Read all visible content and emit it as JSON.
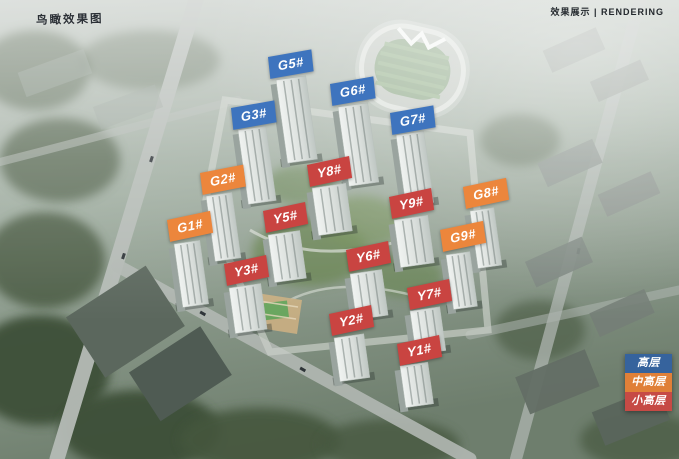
{
  "annotations": {
    "top_left_caption": "鸟瞰效果图",
    "top_right_caption": "效果展示 | RENDERING"
  },
  "colors": {
    "high_rise": "#3E74BE",
    "mid_high_rise": "#EC863C",
    "small_high_rise": "#C94441"
  },
  "legend": {
    "items": [
      {
        "label": "高层",
        "type": "high_rise",
        "color": "#36639D"
      },
      {
        "label": "中高层",
        "type": "mid_high_rise",
        "color": "#E08038"
      },
      {
        "label": "小高层",
        "type": "small_high_rise",
        "color": "#C64A45"
      }
    ]
  },
  "buildings": [
    {
      "id": "G5#",
      "type": "high_rise",
      "label_x": 268,
      "label_y": 57,
      "rot": -10,
      "tower": {
        "x": 276,
        "y": 80,
        "w": 30,
        "h": 84
      }
    },
    {
      "id": "G6#",
      "type": "high_rise",
      "label_x": 330,
      "label_y": 84,
      "rot": -10,
      "tower": {
        "x": 338,
        "y": 107,
        "w": 30,
        "h": 80
      }
    },
    {
      "id": "G3#",
      "type": "high_rise",
      "label_x": 231,
      "label_y": 108,
      "rot": -10,
      "tower": {
        "x": 238,
        "y": 130,
        "w": 28,
        "h": 75
      }
    },
    {
      "id": "G7#",
      "type": "high_rise",
      "label_x": 390,
      "label_y": 113,
      "rot": -10,
      "tower": {
        "x": 396,
        "y": 135,
        "w": 28,
        "h": 72
      }
    },
    {
      "id": "G2#",
      "type": "mid_high_rise",
      "label_x": 200,
      "label_y": 173,
      "rot": -11,
      "tower": {
        "x": 206,
        "y": 196,
        "w": 26,
        "h": 66
      }
    },
    {
      "id": "G1#",
      "type": "mid_high_rise",
      "label_x": 167,
      "label_y": 220,
      "rot": -12,
      "tower": {
        "x": 174,
        "y": 244,
        "w": 26,
        "h": 64
      }
    },
    {
      "id": "G8#",
      "type": "mid_high_rise",
      "label_x": 463,
      "label_y": 187,
      "rot": -12,
      "tower": {
        "x": 470,
        "y": 211,
        "w": 24,
        "h": 58
      }
    },
    {
      "id": "G9#",
      "type": "mid_high_rise",
      "label_x": 440,
      "label_y": 230,
      "rot": -12,
      "tower": {
        "x": 446,
        "y": 255,
        "w": 24,
        "h": 55
      }
    },
    {
      "id": "Y8#",
      "type": "small_high_rise",
      "label_x": 307,
      "label_y": 165,
      "rot": -12,
      "tower": {
        "x": 312,
        "y": 188,
        "w": 34,
        "h": 48
      }
    },
    {
      "id": "Y9#",
      "type": "small_high_rise",
      "label_x": 389,
      "label_y": 197,
      "rot": -12,
      "tower": {
        "x": 394,
        "y": 220,
        "w": 34,
        "h": 48
      }
    },
    {
      "id": "Y5#",
      "type": "small_high_rise",
      "label_x": 263,
      "label_y": 211,
      "rot": -12,
      "tower": {
        "x": 268,
        "y": 235,
        "w": 32,
        "h": 48
      }
    },
    {
      "id": "Y6#",
      "type": "small_high_rise",
      "label_x": 346,
      "label_y": 250,
      "rot": -12,
      "tower": {
        "x": 350,
        "y": 274,
        "w": 32,
        "h": 46
      }
    },
    {
      "id": "Y3#",
      "type": "small_high_rise",
      "label_x": 224,
      "label_y": 264,
      "rot": -12,
      "tower": {
        "x": 229,
        "y": 288,
        "w": 32,
        "h": 46
      }
    },
    {
      "id": "Y7#",
      "type": "small_high_rise",
      "label_x": 407,
      "label_y": 288,
      "rot": -12,
      "tower": {
        "x": 410,
        "y": 311,
        "w": 30,
        "h": 44
      }
    },
    {
      "id": "Y2#",
      "type": "small_high_rise",
      "label_x": 329,
      "label_y": 314,
      "rot": -12,
      "tower": {
        "x": 334,
        "y": 338,
        "w": 30,
        "h": 44
      }
    },
    {
      "id": "Y1#",
      "type": "small_high_rise",
      "label_x": 397,
      "label_y": 344,
      "rot": -12,
      "tower": {
        "x": 400,
        "y": 366,
        "w": 28,
        "h": 42
      }
    }
  ]
}
